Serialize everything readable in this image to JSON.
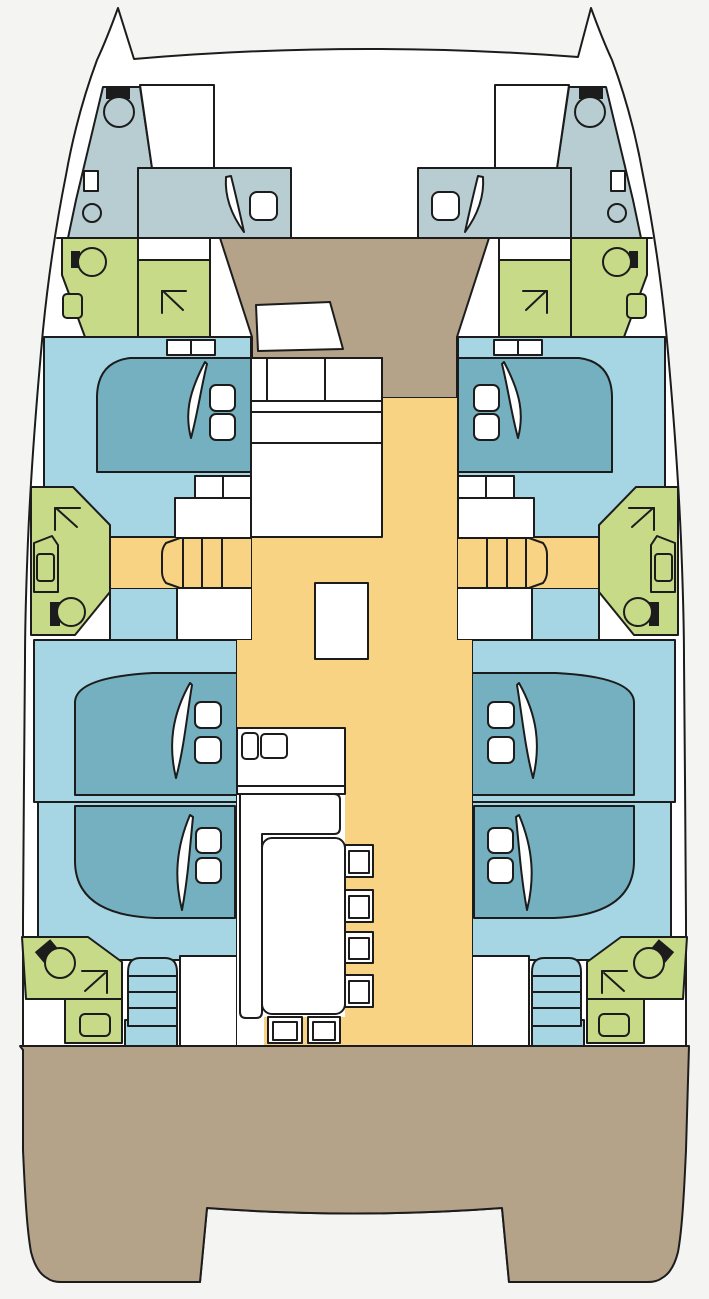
{
  "document": {
    "title": "Catamaran saloon-deck floor plan",
    "type": "yacht-deck-plan"
  },
  "palette": {
    "background": "#f4f4f3",
    "hull": "#ffffff",
    "outline": "#1c1c1c",
    "crew_area": "#b8cdd1",
    "cabin_floor": "#a6d6e4",
    "bed": "#74b0bf",
    "bathroom": "#c6da88",
    "walkway": "#f8d383",
    "deck": "#b4a289",
    "furniture": "#ffffff"
  },
  "legend": {
    "boat": "Catamaran hull silhouette with twin bows",
    "port_hull": "Port hull: bow crew cabin, bathroom, forward cabin, mid bathroom, stairs, two aft cabins, aft bathroom, companionway",
    "starboard_hull": "Starboard hull (mirror of port hull)",
    "bow_crew_cabin": "Bow crew cabin with toilet, sink and berth",
    "bow_locker": "Anchor locker",
    "crew_berth": "Crew berth with pillow",
    "fore_bathroom": "Forward bathroom: toilet, sink and separate shower",
    "fore_cabin_bed": "Forward guest cabin double berth",
    "mid_bathroom": "Midship bathroom: shower, sink and toilet",
    "hull_stairs": "Steps from saloon down into hull",
    "aft_cabin_bed": "Aft guest cabin double berth",
    "aft_most_bed": "Aftmost guest cabin double berth",
    "aft_bathroom": "Aft bathroom: toilet, shower and sink",
    "companionway": "Companionway steps from aft deck",
    "fore_cockpit": "Forward cockpit deck",
    "sun_pad": "Forward cockpit cushion",
    "saloon_seating": "Saloon forward seating and chart area",
    "walkway": "Saloon and corridor walkway floor",
    "island": "Saloon island unit",
    "galley_counter": "Galley counter with twin sinks",
    "dinette_bench": "Dinette L-shaped bench",
    "dinette_table": "Dinette table",
    "dinette_chair": "Dinette chair",
    "aft_deck": "Aft cockpit deck",
    "transom_notch": "Transom opening between sugar-scoop steps",
    "toilet_icon": "toilet",
    "sink_icon": "sink",
    "shower_icon": "shower arrow symbol"
  },
  "features": {
    "guest_cabins": 6,
    "crew_cabins": 2,
    "bathrooms": 6,
    "shower_symbols": 6,
    "toilets": 8,
    "saloon_stairs": 2,
    "companionways": 2,
    "dinette_chairs": 6
  }
}
